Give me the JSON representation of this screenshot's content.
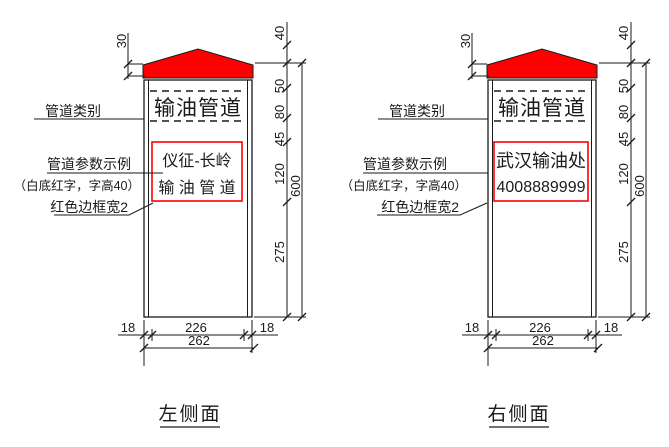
{
  "palette": {
    "red": "#ff0000"
  },
  "views": [
    {
      "caption": "左侧面",
      "post": {
        "header": "输油管道",
        "panel": {
          "line1": "仪征-长岭",
          "line2": "输 油 管 道"
        }
      },
      "callouts": {
        "category": "管道类别",
        "params": "管道参数示例",
        "params_note": "（白底红字，字高40）",
        "border": "红色边框宽2"
      },
      "dims": {
        "cap_height": "30",
        "chain": [
          "40",
          "50",
          "80",
          "45",
          "120",
          "275"
        ],
        "overall": "600",
        "bottom": [
          "18",
          "226",
          "18"
        ],
        "bottom_total": "262"
      }
    },
    {
      "caption": "右侧面",
      "post": {
        "header": "输油管道",
        "panel": {
          "line1": "武汉输油处",
          "line2": "4008889999"
        }
      },
      "callouts": {
        "category": "管道类别",
        "params": "管道参数示例",
        "params_note": "（白底红字，字高40）",
        "border": "红色边框宽2"
      },
      "dims": {
        "cap_height": "30",
        "chain": [
          "40",
          "50",
          "80",
          "45",
          "120",
          "275"
        ],
        "overall": "600",
        "bottom": [
          "18",
          "226",
          "18"
        ],
        "bottom_total": "262"
      }
    }
  ]
}
